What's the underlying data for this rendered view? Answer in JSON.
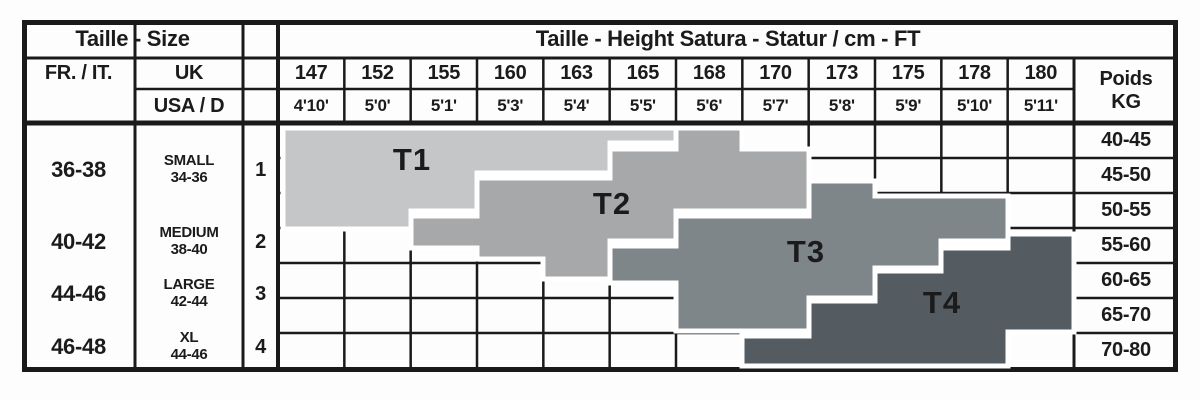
{
  "title_row": {
    "size_title": "Taille - Size",
    "height_title": "Taille - Height Satura - Statur / cm - FT"
  },
  "col_headers": {
    "fr_it": "FR. / IT.",
    "uk": "UK",
    "usa_d": "USA / D",
    "weight_line1": "Poids",
    "weight_line2": "KG"
  },
  "sizes": [
    {
      "fr_it": "36-38",
      "label": "SMALL",
      "uk_range": "34-36",
      "index": "1"
    },
    {
      "fr_it": "40-42",
      "label": "MEDIUM",
      "uk_range": "38-40",
      "index": "2"
    },
    {
      "fr_it": "44-46",
      "label": "LARGE",
      "uk_range": "42-44",
      "index": "3"
    },
    {
      "fr_it": "46-48",
      "label": "XL",
      "uk_range": "44-46",
      "index": "4"
    }
  ],
  "chart_data": {
    "type": "heatmap",
    "title": "Taille - Height Satura - Statur / cm - FT",
    "xlabel": "Height (cm / ft)",
    "ylabel": "Poids KG (weight)",
    "x_cm": [
      "147",
      "152",
      "155",
      "160",
      "163",
      "165",
      "168",
      "170",
      "173",
      "175",
      "178",
      "180"
    ],
    "x_ft": [
      "4'10'",
      "5'0'",
      "5'1'",
      "5'3'",
      "5'4'",
      "5'5'",
      "5'6'",
      "5'7'",
      "5'8'",
      "5'9'",
      "5'10'",
      "5'11'"
    ],
    "y_kg": [
      "40-45",
      "45-50",
      "50-55",
      "55-60",
      "60-65",
      "65-70",
      "70-80"
    ],
    "grid": {
      "columns": 12,
      "rows": 7
    },
    "bands": [
      {
        "label": "T1",
        "color": "#c5c6c8",
        "points": "283,128 676,128 676,143 610,143 610,173 477,173 477,211 411,211 411,229 283,229"
      },
      {
        "label": "T2",
        "color": "#a6a8aa",
        "points": "411,216 477,216 477,178 610,178 610,149 676,149 676,128 742,128 742,149 809,149 809,211 676,211 676,241 610,241 610,279 543,279 543,259 477,259 477,248 411,248"
      },
      {
        "label": "T3",
        "color": "#7f868a",
        "points": "610,246 676,246 676,216 809,216 809,181 875,181 875,196 1008,196 1008,241 941,241 941,268 875,268 875,298 809,298 809,331 676,331 676,283 610,283"
      },
      {
        "label": "T4",
        "color": "#545c62",
        "points": "742,336 809,336 809,301 875,301 875,271 941,271 941,248 1008,248 1008,234 1074,234 1074,332 1008,332 1008,366 742,366"
      }
    ]
  },
  "colors": {
    "line": "#1a1a1a",
    "text": "#1b1b1b",
    "background": "#fdfdfd",
    "band_gap": "#ffffff"
  }
}
